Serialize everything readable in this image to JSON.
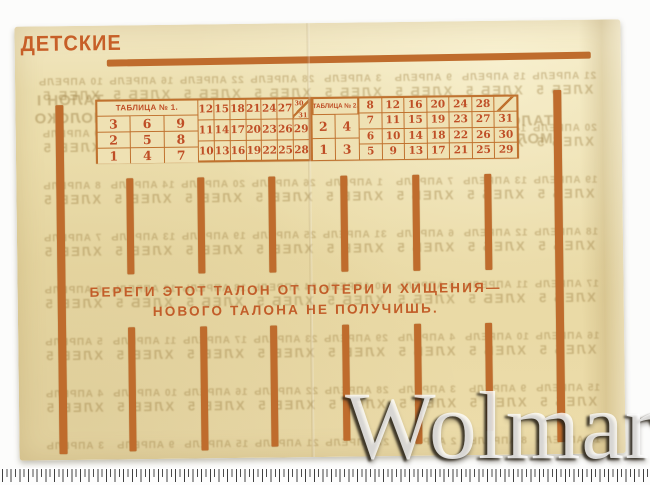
{
  "scan": {
    "watermark": "Wolmar"
  },
  "card": {
    "title": "ДЕТСКИЕ",
    "warning": {
      "line1": "БЕРЕГИ ЭТОТ ТАЛОН ОТ ПОТЕРИ И ХИЩЕНИЯ—",
      "line2": "НОВОГО ТАЛОНА НЕ ПОЛУЧИШЬ."
    },
    "tables": [
      {
        "header": "ТАБЛИЦА № 1.",
        "left_rows": [
          [
            "3",
            "6",
            "9"
          ],
          [
            "2",
            "5",
            "8"
          ],
          [
            "1",
            "4",
            "7"
          ]
        ],
        "right_rows": [
          [
            "12",
            "15",
            "18",
            "21",
            "24",
            "27"
          ],
          [
            "11",
            "14",
            "17",
            "20",
            "23",
            "26",
            "29"
          ],
          [
            "10",
            "13",
            "16",
            "19",
            "22",
            "25",
            "28"
          ]
        ],
        "diagonal_cell": {
          "top": "30",
          "bottom": "31"
        }
      },
      {
        "header": "ТАБЛИЦА № 2.",
        "left_rows": [
          [
            "2",
            "4"
          ],
          [
            "1",
            "3"
          ]
        ],
        "right_rows": [
          [
            "8",
            "12",
            "16",
            "20",
            "24",
            "28"
          ],
          [
            "7",
            "11",
            "15",
            "19",
            "23",
            "27",
            "31"
          ],
          [
            "6",
            "10",
            "14",
            "18",
            "22",
            "26",
            "30"
          ],
          [
            "5",
            "9",
            "13",
            "17",
            "21",
            "25",
            "29"
          ]
        ],
        "diagonal_cell": {
          "top": "",
          "bottom": ""
        }
      }
    ],
    "colors": {
      "ink_orange": "#c0722f",
      "ink_red": "#bf4e26",
      "paper": "#ebdcaa"
    }
  },
  "ghost": {
    "month": "АПРЕЛЬ",
    "product": "ХЛЕБ 5",
    "big_left": [
      "ТАЛОН I",
      "МОЛОКО"
    ],
    "big_right": [
      "ТАЛОН И",
      "МОЛОКО"
    ],
    "dates": [
      [
        21,
        15,
        9,
        3,
        28,
        22,
        16,
        10
      ],
      [
        20,
        14,
        8,
        2,
        27,
        21,
        15,
        9
      ],
      [
        19,
        13,
        7,
        1,
        26,
        20,
        14,
        8
      ],
      [
        18,
        12,
        6,
        31,
        25,
        19,
        13,
        7
      ],
      [
        17,
        11,
        5,
        30,
        24,
        18,
        12,
        6
      ],
      [
        16,
        10,
        4,
        29,
        23,
        17,
        11,
        5
      ],
      [
        15,
        9,
        3,
        28,
        22,
        16,
        10,
        4
      ],
      [
        14,
        8,
        2,
        27,
        21,
        15,
        9,
        3
      ]
    ]
  }
}
